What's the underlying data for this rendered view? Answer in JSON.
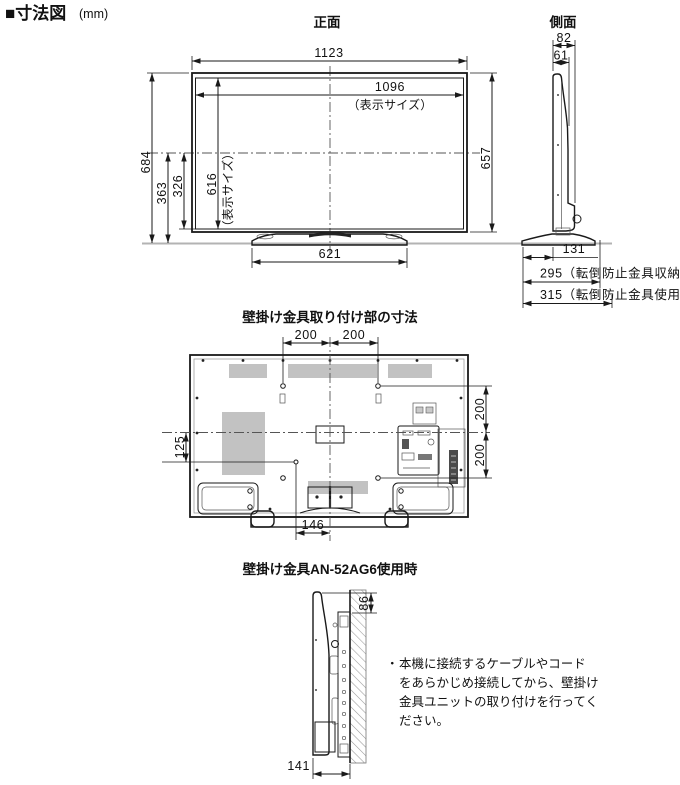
{
  "header": {
    "title": "■寸法図",
    "unit": "(mm)"
  },
  "front_view": {
    "label": "正面",
    "width_total": "1123",
    "display_width": "1096",
    "display_note": "（表示サイズ）",
    "height_total": "684",
    "height_center_to_base": "363",
    "height_center_to_panel_bottom": "326",
    "display_height": "616",
    "display_height_note": "（表示サイズ）",
    "panel_height": "657",
    "stand_width": "621"
  },
  "side_view": {
    "label": "側面",
    "depth_with_protrusion": "82",
    "depth_panel": "61",
    "depth_stand_front": "131",
    "depth_antitip_stowed": "295（転倒防止金具収納時）",
    "depth_antitip_in_use": "315（転倒防止金具使用時）"
  },
  "rear_view": {
    "title": "壁掛け金具取り付け部の寸法",
    "span_h_left": "200",
    "span_h_right": "200",
    "span_v_top": "200",
    "span_v_bottom": "200",
    "offset_left": "125",
    "offset_stand": "146"
  },
  "bracket_view": {
    "title": "壁掛け金具AN-52AG6使用時",
    "clearance_top": "86",
    "depth_wall": "141",
    "note_bullet": "・",
    "note_lines": [
      "本機に接続するケーブルやコード",
      "をあらかじめ接続してから、壁掛け",
      "金具ユニットの取り付けを行ってく",
      "ださい。"
    ]
  },
  "colors": {
    "line": "#1a1a1a",
    "rear_body_fill": "#dcdcdc",
    "vent_fill": "#c2c2c2",
    "profile_fill": "#ededed",
    "baseline": "#b3b3b3"
  }
}
